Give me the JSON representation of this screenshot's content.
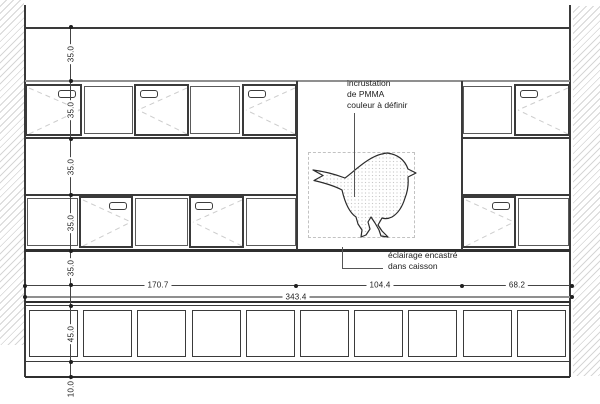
{
  "notes": {
    "pmma": [
      "incrustation",
      "de PMMA",
      "couleur à définir"
    ],
    "lighting": [
      "éclairage encastré",
      "dans caisson"
    ]
  },
  "dims": {
    "vertical": [
      "35.0",
      "35.0",
      "35.0",
      "35.0",
      "35.0",
      "45.0",
      "10.0"
    ],
    "horizontal": [
      "170.7",
      "104.4",
      "68.2"
    ],
    "total": "343.4"
  },
  "colors": {
    "line_dark": "#3a3a3a",
    "line_gray": "#8f8f8f",
    "line_heavy": "#2f2f2f",
    "swing_line": "#cdcdcd",
    "hatch": "#d6d6d6",
    "bird_dots": "#c8c8c8"
  }
}
